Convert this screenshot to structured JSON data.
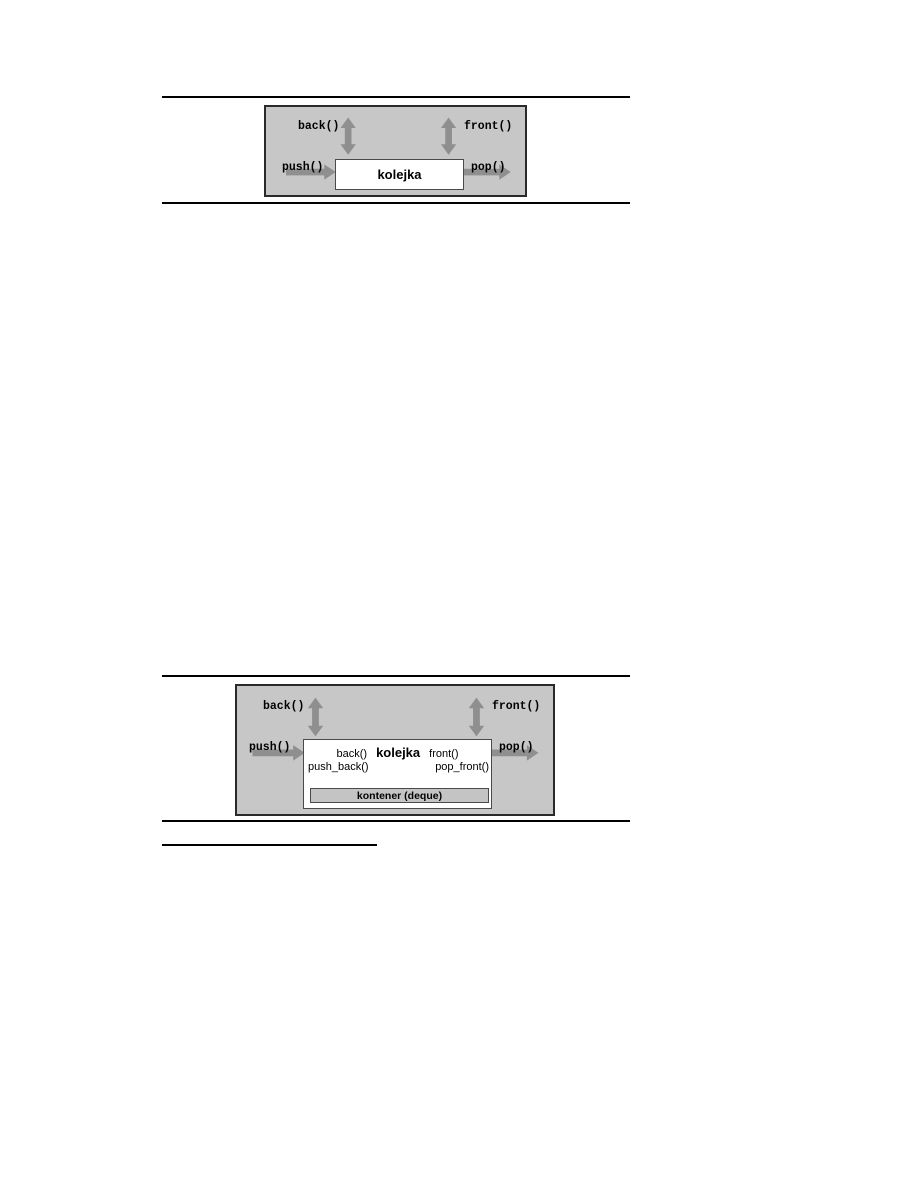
{
  "colors": {
    "diagram_bg": "#c7c7c7",
    "bar_bg": "#c4c4c4",
    "arrow": "#8f8f8f",
    "outer_border": "#2a2a2a",
    "box_border": "#4a4a4a",
    "rule": "#000000"
  },
  "figure1": {
    "back_label": "back()",
    "front_label": "front()",
    "push_label": "push()",
    "pop_label": "pop()",
    "box_title": "kolejka"
  },
  "figure2": {
    "back_label": "back()",
    "front_label": "front()",
    "push_label": "push()",
    "pop_label": "pop()",
    "box_title": "kolejka",
    "inner_back_label": "back()",
    "inner_front_label": "front()",
    "push_back_label": "push_back()",
    "pop_front_label": "pop_front()",
    "container_label": "kontener (deque)"
  }
}
